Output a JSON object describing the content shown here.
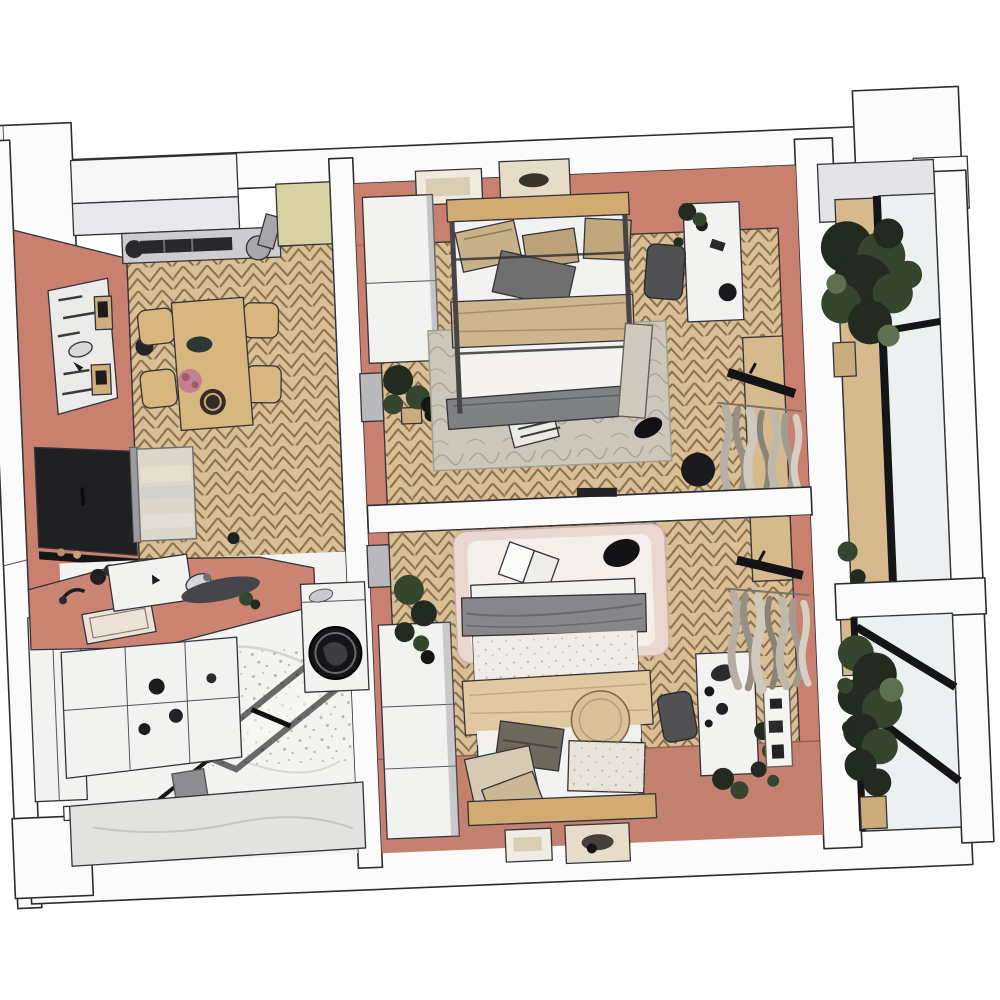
{
  "scene": {
    "title": "Apartment 3D floor plan — top-down cutaway rendering",
    "style": "architectural render, white background, cut walls shown white",
    "view": "top-down axonometric with slight counter-clockwise tilt"
  },
  "palette": {
    "background": "#ffffff",
    "wall_cut": "#fbfbfc",
    "wall_gray": "#e4e4e6",
    "terracotta": "#c9806e",
    "terracotta_floor": "#c5816f",
    "counter": "#cc8472",
    "parquet": "#d8bf96",
    "parquet_line": "#8c6e4b",
    "marble": "#f3f3f1",
    "marble_wall": "#e2e2e0",
    "wood": "#d6ba8e",
    "headboard": "#d2ab72",
    "table": "#d8b77e",
    "cabinet_yellow": "#d8d2a2",
    "furniture_white": "#f2f2f0",
    "metal_gray": "#cdcdd0",
    "blanket_gray": "#7e8082",
    "blanket_tan": "#cdb58d",
    "duvet_tan": "#e2c8a1",
    "rug_gray": "#ccc7bb",
    "rug_pink": "#ead8d0",
    "rug_pink_inner": "#f4efeb",
    "plant_dark": "#232b20",
    "plant_mid": "#36452e",
    "plant_light": "#5d7150",
    "frame_black": "#151517",
    "glass": "#edf0f0",
    "tv": "#202023",
    "door_gray": "#b9b9bc",
    "chair_gray": "#515154"
  },
  "rooms": [
    {
      "id": "living-dining",
      "name": "Living / dining room",
      "floor": "herringbone parquet",
      "furniture": [
        "ceiling AC unit with duct",
        "tall yellow cabinet",
        "dining table",
        "four dining chairs",
        "wall pegboard with shelves and mirror",
        "wall-mounted TV",
        "media shelf",
        "glass display cabinet",
        "black stool"
      ]
    },
    {
      "id": "kitchen",
      "name": "Kitchen corner",
      "floor": "herringbone parquet",
      "furniture": [
        "terracotta countertop",
        "inset sink",
        "coffee machine",
        "cutting board",
        "kitchen island",
        "white bench"
      ]
    },
    {
      "id": "bathroom",
      "name": "Bathroom / laundry",
      "floor": "marble and terrazzo tile",
      "furniture": [
        "washing machine with laundry",
        "walk-in shower glass screen",
        "shower mixer panel",
        "marble half wall"
      ]
    },
    {
      "id": "bedroom-1",
      "name": "Bedroom 1",
      "floor": "herringbone parquet",
      "furniture": [
        "double bed with metal frame",
        "wooden headboard",
        "two wall art frames",
        "white wardrobe",
        "potted plants",
        "gray area rug",
        "desk with chair",
        "leaning mirror",
        "window with curtains",
        "floor pouf"
      ]
    },
    {
      "id": "bedroom-2",
      "name": "Bedroom 2",
      "floor": "herringbone parquet",
      "furniture": [
        "double bed with round cushion",
        "wooden headboard",
        "two wall art frames",
        "white wardrobe",
        "potted plants",
        "pink area rug with open book",
        "dresser with chair",
        "window with curtains",
        "wall mirror"
      ]
    },
    {
      "id": "balcony",
      "name": "Glazed balcony",
      "floor": "wood planks",
      "furniture": [
        "large potted tree",
        "tall potted plant",
        "black framed glazing"
      ]
    }
  ]
}
